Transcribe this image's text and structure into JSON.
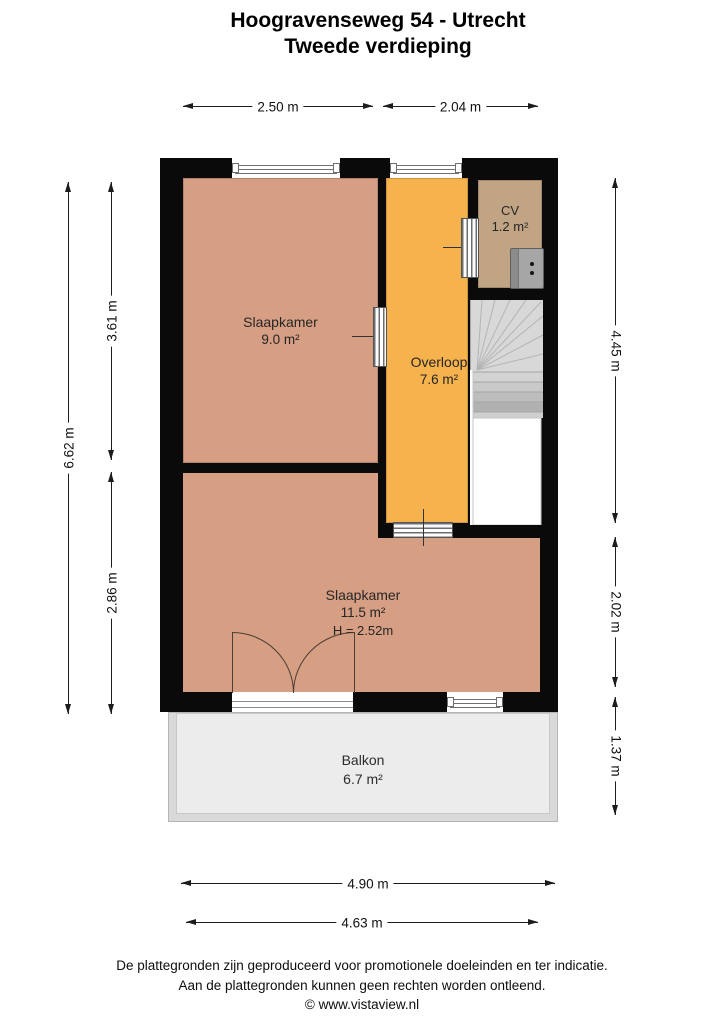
{
  "title": {
    "address": "Hoogravenseweg 54 - Utrecht",
    "floor": "Tweede verdieping"
  },
  "rooms": {
    "slaapkamer1": {
      "name": "Slaapkamer",
      "area": "9.0 m²"
    },
    "overloop": {
      "name": "Overloop",
      "area": "7.6 m²"
    },
    "cv": {
      "name": "CV",
      "area": "1.2 m²"
    },
    "slaapkamer2": {
      "name": "Slaapkamer",
      "area": "11.5 m²",
      "ceiling_height": "H = 2.52m"
    },
    "balkon": {
      "name": "Balkon",
      "area": "6.7 m²"
    }
  },
  "dimensions": {
    "top": [
      "2.50 m",
      "2.04 m"
    ],
    "left_total": "6.62 m",
    "left_segments": [
      "3.61 m",
      "2.86 m"
    ],
    "right_segments": [
      "4.45 m",
      "2.02 m",
      "1.37 m"
    ],
    "bottom": [
      "4.90 m",
      "4.63 m"
    ]
  },
  "footer": {
    "line1": "De plattegronden zijn geproduceerd voor promotionele doeleinden en ter indicatie.",
    "line2": "Aan de plattegronden kunnen geen rechten worden ontleend.",
    "line3": "© www.vistaview.nl"
  },
  "colors": {
    "walls": "#0a0a0a",
    "bedroom": "#d69e82",
    "hallway": "#f6b24c",
    "cv_room": "#c1a484",
    "stairs": "#d8d8d8",
    "balcony": "#ececec",
    "background": "#ffffff"
  }
}
